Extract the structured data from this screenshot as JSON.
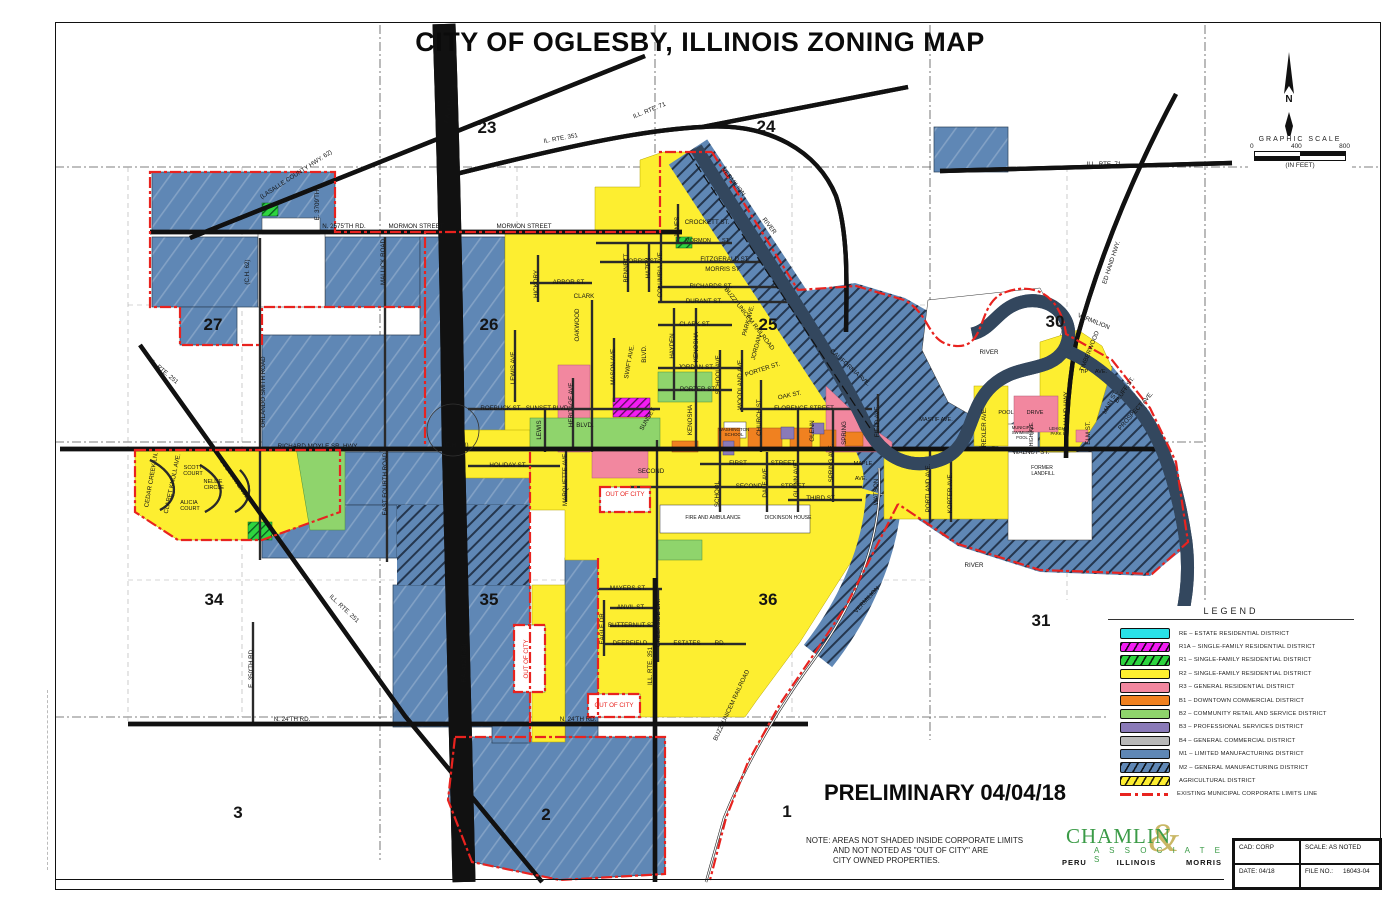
{
  "title": "CITY OF OGLESBY, ILLINOIS ZONING MAP",
  "preliminary": "PRELIMINARY 04/04/18",
  "north": {
    "label": "N"
  },
  "scalebar": {
    "title": "GRAPHIC SCALE",
    "ticks": [
      "0",
      "400",
      "800"
    ],
    "units": "(IN FEET)"
  },
  "note": {
    "label": "NOTE:",
    "lines": [
      "AREAS NOT SHADED INSIDE CORPORATE LIMITS",
      "AND NOT NOTED AS \"OUT OF CITY\" ARE",
      "CITY OWNED PROPERTIES."
    ]
  },
  "firm": {
    "name": "CHAMLIN",
    "ampersand": "&",
    "associates": "A S S O C I A T E S",
    "cities": [
      "PERU",
      "ILLINOIS",
      "MORRIS"
    ]
  },
  "title_block": {
    "cad": "CAD: CORP",
    "scale": "SCALE: AS NOTED",
    "date": "DATE: 04/18",
    "file_label": "FILE NO.:",
    "file_no": "16043-04"
  },
  "legend": {
    "title": "LEGEND",
    "items": [
      {
        "code": "RE",
        "name": "ESTATE RESIDENTIAL DISTRICT",
        "color": "#29e1e8",
        "hatch": false
      },
      {
        "code": "R1A",
        "name": "SINGLE-FAMILY RESIDENTIAL DISTRICT",
        "color": "#f31cf3",
        "hatch": true
      },
      {
        "code": "R1",
        "name": "SINGLE-FAMILY RESIDENTIAL DISTRICT",
        "color": "#2ed53f",
        "hatch": true
      },
      {
        "code": "R2",
        "name": "SINGLE-FAMILY RESIDENTIAL DISTRICT",
        "color": "#fdee30",
        "hatch": false
      },
      {
        "code": "R3",
        "name": "GENERAL RESIDENTIAL DISTRICT",
        "color": "#f2879f",
        "hatch": false
      },
      {
        "code": "B1",
        "name": "DOWNTOWN COMMERCIAL DISTRICT",
        "color": "#f08120",
        "hatch": false
      },
      {
        "code": "B2",
        "name": "COMMUNITY RETAIL AND SERVICE DISTRICT",
        "color": "#8fd46c",
        "hatch": false
      },
      {
        "code": "B3",
        "name": "PROFESSIONAL SERVICES DISTRICT",
        "color": "#8a7ab8",
        "hatch": false
      },
      {
        "code": "B4",
        "name": "GENERAL COMMERCIAL DISTRICT",
        "color": "#b9b9b9",
        "hatch": false
      },
      {
        "code": "M1",
        "name": "LIMITED MANUFACTURING DISTRICT",
        "color": "#5f87b5",
        "hatch": false
      },
      {
        "code": "M2",
        "name": "GENERAL MANUFACTURING DISTRICT",
        "color": "#5f87b5",
        "hatch": true
      },
      {
        "code": "",
        "name": "AGRICULTURAL DISTRICT",
        "color": "#fdee30",
        "hatch": true
      },
      {
        "code": "",
        "name": "EXISTING MUNICIPAL CORPORATE LIMITS LINE",
        "color": "#e8231f",
        "line": true
      }
    ]
  },
  "colors": {
    "m1": "#5f87b5",
    "m2_ink": "#24364e",
    "r2": "#fdee30",
    "r3": "#f2879f",
    "b1": "#f08120",
    "b2": "#8fd46c",
    "b3": "#8a7ab8",
    "b4": "#b9b9b9",
    "re": "#29e1e8",
    "r1": "#2ed53f",
    "r1a": "#f31cf3",
    "limits": "#e8231f",
    "firm_green": "#3b9b47",
    "firm_tan": "#c9b765"
  },
  "sections": [
    {
      "n": "23",
      "x": 487,
      "y": 133
    },
    {
      "n": "24",
      "x": 766,
      "y": 132
    },
    {
      "n": "27",
      "x": 213,
      "y": 330
    },
    {
      "n": "26",
      "x": 489,
      "y": 330
    },
    {
      "n": "25",
      "x": 768,
      "y": 330
    },
    {
      "n": "30",
      "x": 1055,
      "y": 327
    },
    {
      "n": "34",
      "x": 214,
      "y": 605
    },
    {
      "n": "35",
      "x": 489,
      "y": 605
    },
    {
      "n": "36",
      "x": 768,
      "y": 605
    },
    {
      "n": "31",
      "x": 1041,
      "y": 626
    },
    {
      "n": "3",
      "x": 238,
      "y": 818
    },
    {
      "n": "2",
      "x": 546,
      "y": 820
    },
    {
      "n": "1",
      "x": 787,
      "y": 817
    }
  ],
  "map_labels": [
    {
      "t": "(LASALLE COUNTY HWY. 62)",
      "x": 297,
      "y": 176,
      "r": -33
    },
    {
      "t": "E. 3709'TH",
      "x": 319,
      "y": 205,
      "r": -90
    },
    {
      "t": "N. 2575'TH RD.",
      "x": 344,
      "y": 228
    },
    {
      "t": "MORMON STREET",
      "x": 416,
      "y": 228
    },
    {
      "t": "MORMON STREET",
      "x": 524,
      "y": 228
    },
    {
      "t": "(C.H. 62)",
      "x": 249,
      "y": 272,
      "r": -90
    },
    {
      "t": "MALLICK ROAD",
      "x": 385,
      "y": 262,
      "r": -90
    },
    {
      "t": "ORLANDO SMITH ROAD",
      "x": 265,
      "y": 392,
      "r": -90
    },
    {
      "t": "RICHARD MOYLE SR. HWY.",
      "x": 318,
      "y": 448
    },
    {
      "t": "(C.H. 23)",
      "x": 456,
      "y": 447
    },
    {
      "t": "EAST FOURTH ROAD",
      "x": 387,
      "y": 484,
      "r": -90
    },
    {
      "t": "IL. RTE. 251",
      "x": 163,
      "y": 373,
      "r": 40
    },
    {
      "t": "ILL. RTE. 251",
      "x": 343,
      "y": 610,
      "r": 43
    },
    {
      "t": "E. 350'TH RD.",
      "x": 253,
      "y": 668,
      "r": -90
    },
    {
      "t": "N. 24'TH RD.",
      "x": 292,
      "y": 721
    },
    {
      "t": "N. 24'TH RD.",
      "x": 578,
      "y": 721
    },
    {
      "t": "F.A. 412 (I-39)",
      "x": 452,
      "y": 104,
      "r": -78
    },
    {
      "t": "F.A. 412 (I-39)",
      "x": 466,
      "y": 663,
      "r": -90
    },
    {
      "t": "IL. RTE. 351",
      "x": 561,
      "y": 140,
      "r": -10
    },
    {
      "t": "ILL. RTE. 351",
      "x": 652,
      "y": 666,
      "r": -90
    },
    {
      "t": "ILL. RTE. 71",
      "x": 650,
      "y": 112,
      "r": -22
    },
    {
      "t": "ILL. RTE. 71",
      "x": 1104,
      "y": 166
    },
    {
      "t": "ED HAND HWY.",
      "x": 1113,
      "y": 263,
      "r": -72
    },
    {
      "t": "ED HAND HWY.",
      "x": 1068,
      "y": 413,
      "r": -90
    },
    {
      "t": "CEDAR CREEK LN.",
      "x": 153,
      "y": 480,
      "r": -80
    },
    {
      "t": "CLARET KNOLL AVE.",
      "x": 174,
      "y": 484,
      "r": -78
    },
    {
      "t": "SCOTT",
      "x": 193,
      "y": 469,
      "s": 5.5
    },
    {
      "t": "COURT",
      "x": 193,
      "y": 475,
      "s": 5.5
    },
    {
      "t": "NELLIE",
      "x": 213,
      "y": 483,
      "s": 5.5
    },
    {
      "t": "CIRCLE",
      "x": 214,
      "y": 489,
      "s": 5.5
    },
    {
      "t": "ALICIA",
      "x": 189,
      "y": 504,
      "s": 5.5
    },
    {
      "t": "COURT",
      "x": 190,
      "y": 510,
      "s": 5.5
    },
    {
      "t": "SCOTT AVENUE",
      "x": 233,
      "y": 480,
      "r": 55
    },
    {
      "t": "HICKORY",
      "x": 538,
      "y": 284,
      "r": -90
    },
    {
      "t": "ARBOR ST.",
      "x": 569,
      "y": 284
    },
    {
      "t": "CLARK",
      "x": 584,
      "y": 298
    },
    {
      "t": "OAKWOOD",
      "x": 579,
      "y": 325,
      "r": -90
    },
    {
      "t": "LEWIS AVE.",
      "x": 515,
      "y": 367,
      "r": -90
    },
    {
      "t": "LEWIS",
      "x": 541,
      "y": 430,
      "r": -90
    },
    {
      "t": "ROEBUCK ST.",
      "x": 501,
      "y": 410
    },
    {
      "t": "SUNSET BLVD.",
      "x": 548,
      "y": 410
    },
    {
      "t": "HERITAGE AVE.",
      "x": 573,
      "y": 404,
      "r": -90
    },
    {
      "t": "MASON AVE.",
      "x": 615,
      "y": 366,
      "r": -90
    },
    {
      "t": "SWIFT AVE.",
      "x": 631,
      "y": 362,
      "r": -80
    },
    {
      "t": "BLVD.",
      "x": 646,
      "y": 354,
      "r": -90
    },
    {
      "t": "SUNSET",
      "x": 649,
      "y": 420,
      "r": -60
    },
    {
      "t": "BLVD.",
      "x": 585,
      "y": 427
    },
    {
      "t": "HOLIDAY ST.",
      "x": 508,
      "y": 467
    },
    {
      "t": "MARQUETTE AVE.",
      "x": 567,
      "y": 479,
      "r": -90
    },
    {
      "t": "BENNETT",
      "x": 628,
      "y": 268,
      "r": -90
    },
    {
      "t": "HAZEN",
      "x": 650,
      "y": 268,
      "r": -90
    },
    {
      "t": "COLUMBIA AVE.",
      "x": 662,
      "y": 274,
      "r": -90
    },
    {
      "t": "MORRIS ST.",
      "x": 641,
      "y": 263
    },
    {
      "t": "JONES",
      "x": 679,
      "y": 227,
      "r": -90
    },
    {
      "t": "CROCKETT ST.",
      "x": 707,
      "y": 224
    },
    {
      "t": "MORMON",
      "x": 698,
      "y": 242,
      "s": 5.5
    },
    {
      "t": "ST.",
      "x": 726,
      "y": 242,
      "s": 5.5
    },
    {
      "t": "FITZGERALD ST.",
      "x": 725,
      "y": 261
    },
    {
      "t": "MORRIS ST.",
      "x": 723,
      "y": 271
    },
    {
      "t": "RICHARDS ST.",
      "x": 711,
      "y": 288
    },
    {
      "t": "DURANT ST.",
      "x": 704,
      "y": 303
    },
    {
      "t": "CLARK ST.",
      "x": 695,
      "y": 326
    },
    {
      "t": "HAYDEN",
      "x": 674,
      "y": 346,
      "r": -90
    },
    {
      "t": "KENOSHA",
      "x": 698,
      "y": 347,
      "r": -90
    },
    {
      "t": "JORDAN ST.",
      "x": 696,
      "y": 369
    },
    {
      "t": "SCHOOL AVE.",
      "x": 720,
      "y": 374,
      "r": -90
    },
    {
      "t": "PORTER ST.",
      "x": 698,
      "y": 391
    },
    {
      "t": "PORTER ST.",
      "x": 763,
      "y": 371,
      "r": -18
    },
    {
      "t": "WOODLAND AVE.",
      "x": 742,
      "y": 384,
      "r": -90
    },
    {
      "t": "PARK AVE.",
      "x": 750,
      "y": 321,
      "r": -75
    },
    {
      "t": "JORDAN",
      "x": 758,
      "y": 348,
      "r": -75
    },
    {
      "t": "CHURCH ST.",
      "x": 761,
      "y": 417,
      "r": -90
    },
    {
      "t": "OAK ST.",
      "x": 790,
      "y": 397,
      "r": -12
    },
    {
      "t": "FLORENCE STREET",
      "x": 804,
      "y": 410
    },
    {
      "t": "CALIFORNIA AVE.",
      "x": 849,
      "y": 369,
      "r": 42
    },
    {
      "t": "KENOSHA",
      "x": 692,
      "y": 420,
      "r": -90
    },
    {
      "t": "SECOND",
      "x": 651,
      "y": 473
    },
    {
      "t": "FIRST",
      "x": 738,
      "y": 465
    },
    {
      "t": "STREET",
      "x": 783,
      "y": 465
    },
    {
      "t": "SECOND",
      "x": 749,
      "y": 488
    },
    {
      "t": "STREET",
      "x": 793,
      "y": 488
    },
    {
      "t": "THIRD ST.",
      "x": 821,
      "y": 500
    },
    {
      "t": "SCHOOL",
      "x": 719,
      "y": 494,
      "r": -90
    },
    {
      "t": "DALE AVE.",
      "x": 767,
      "y": 482,
      "r": -90
    },
    {
      "t": "GLENN AVE.",
      "x": 798,
      "y": 479,
      "r": -90
    },
    {
      "t": "SPRING AVE.",
      "x": 833,
      "y": 463,
      "r": -90
    },
    {
      "t": "GLENN",
      "x": 814,
      "y": 431,
      "r": -90
    },
    {
      "t": "SPRING",
      "x": 846,
      "y": 433,
      "r": -90
    },
    {
      "t": "FIELD AVE.",
      "x": 879,
      "y": 421,
      "r": -90
    },
    {
      "t": "MAPLE",
      "x": 863,
      "y": 465,
      "s": 5.5
    },
    {
      "t": "AVE.",
      "x": 861,
      "y": 480,
      "s": 5.5
    },
    {
      "t": "WATSON",
      "x": 878,
      "y": 492,
      "r": -90
    },
    {
      "t": "PORTLAND AVE.",
      "x": 930,
      "y": 488,
      "r": -90
    },
    {
      "t": "KORTER AVE.",
      "x": 952,
      "y": 493,
      "r": -90
    },
    {
      "t": "MASTIF AVE.",
      "x": 936,
      "y": 421,
      "s": 5.5
    },
    {
      "t": "WASHINGTON",
      "x": 734,
      "y": 431,
      "s": 4.5
    },
    {
      "t": "SCHOOL",
      "x": 734,
      "y": 436,
      "s": 4.5
    },
    {
      "t": "FIRE AND AMBULANCE",
      "x": 713,
      "y": 519,
      "s": 5
    },
    {
      "t": "DICKINSON HOUSE",
      "x": 788,
      "y": 519,
      "s": 5
    },
    {
      "t": "WALNUT ST.",
      "x": 1031,
      "y": 454
    },
    {
      "t": "FORMER",
      "x": 1042,
      "y": 469,
      "s": 5
    },
    {
      "t": "LANDFILL",
      "x": 1043,
      "y": 475,
      "s": 5
    },
    {
      "t": "TREXLER AVE.",
      "x": 986,
      "y": 429,
      "r": -90
    },
    {
      "t": "POOL",
      "x": 1006,
      "y": 414,
      "s": 5.5
    },
    {
      "t": "DRIVE",
      "x": 1035,
      "y": 414,
      "s": 5.5
    },
    {
      "t": "MUNICIPAL",
      "x": 1023,
      "y": 429,
      "s": 4.2
    },
    {
      "t": "SWIMMING",
      "x": 1023,
      "y": 434,
      "s": 4.2
    },
    {
      "t": "POOL",
      "x": 1022,
      "y": 439,
      "s": 4.2
    },
    {
      "t": "LEHIGH AVE.",
      "x": 1033,
      "y": 437,
      "r": -90,
      "s": 5
    },
    {
      "t": "LEHIGH",
      "x": 1057,
      "y": 430,
      "s": 4.2
    },
    {
      "t": "PARK",
      "x": 1056,
      "y": 435,
      "s": 4.2
    },
    {
      "t": "ELM ST.",
      "x": 1090,
      "y": 433,
      "r": -90
    },
    {
      "t": "MAIN ST.",
      "x": 1112,
      "y": 403,
      "r": -62
    },
    {
      "t": "BLUFF ST.",
      "x": 1126,
      "y": 391,
      "r": -55
    },
    {
      "t": "PROSPECT AVE.",
      "x": 1137,
      "y": 412,
      "r": -48
    },
    {
      "t": "TIMBERWOOD",
      "x": 1091,
      "y": 352,
      "r": -68
    },
    {
      "t": "TIP",
      "x": 1084,
      "y": 373,
      "s": 5.5
    },
    {
      "t": "AVE.",
      "x": 1101,
      "y": 373,
      "s": 5.5
    },
    {
      "t": "VERMILION",
      "x": 732,
      "y": 183,
      "r": 52
    },
    {
      "t": "RIVER",
      "x": 768,
      "y": 227,
      "r": 52
    },
    {
      "t": "VERMILION",
      "x": 1093,
      "y": 323,
      "r": 22
    },
    {
      "t": "RIVER",
      "x": 989,
      "y": 354
    },
    {
      "t": "VERMILION",
      "x": 868,
      "y": 601,
      "r": -47
    },
    {
      "t": "RIVER",
      "x": 974,
      "y": 567
    },
    {
      "t": "BUZZI UNICEM RAILROAD",
      "x": 748,
      "y": 320,
      "r": 52
    },
    {
      "t": "BUZZI UNICEM RAILROAD",
      "x": 733,
      "y": 706,
      "r": -65
    },
    {
      "t": "MAYERS ST.",
      "x": 628,
      "y": 590
    },
    {
      "t": "ANVIL ST.",
      "x": 631,
      "y": 609
    },
    {
      "t": "BUTTERNUT ST.",
      "x": 632,
      "y": 627
    },
    {
      "t": "DEERFIELD",
      "x": 630,
      "y": 645
    },
    {
      "t": "ESTATES",
      "x": 687,
      "y": 645
    },
    {
      "t": "RD.",
      "x": 720,
      "y": 645
    },
    {
      "t": "EAGLE DR.",
      "x": 604,
      "y": 628,
      "r": -90
    },
    {
      "t": "CREEKSIDE DR.",
      "x": 660,
      "y": 623,
      "r": -90
    },
    {
      "t": "OUT OF CITY",
      "x": 625,
      "y": 496,
      "c": "#e8231f"
    },
    {
      "t": "OUT OF CITY",
      "x": 614,
      "y": 707,
      "c": "#e8231f"
    },
    {
      "t": "OUT OF CITY",
      "x": 528,
      "y": 659,
      "r": -90,
      "c": "#e8231f"
    }
  ]
}
